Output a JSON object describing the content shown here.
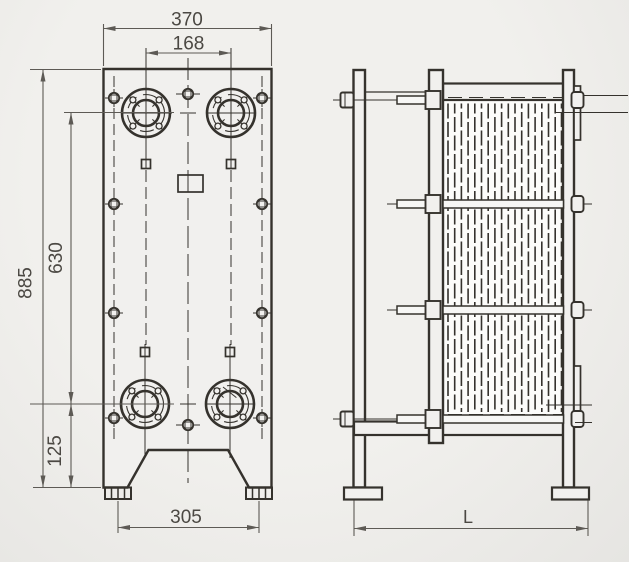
{
  "front_view": {
    "dim_overall_width": "370",
    "dim_port_horizontal_spacing": "168",
    "dim_overall_height": "885",
    "dim_port_vertical_spacing": "630",
    "dim_port_to_foot": "125",
    "dim_foot_spacing": "305"
  },
  "side_view": {
    "dim_overall_length": "L"
  },
  "colors": {
    "background": "#f1f0ed",
    "background_edge": "#e6e5e2",
    "object_line": "#35322d",
    "dim_line": "#5d5a55",
    "text": "#4b4843",
    "paper": "#f1f0ee",
    "pack_bg": "#fcfcfa",
    "rod_fill": "#f7f7f5"
  }
}
